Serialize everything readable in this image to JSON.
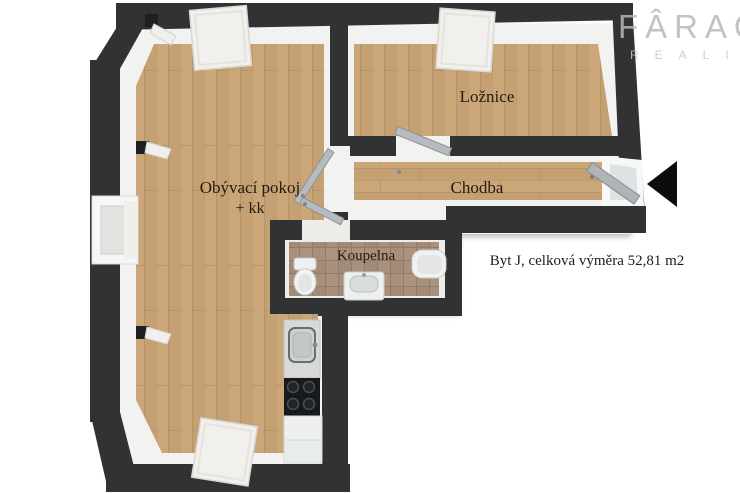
{
  "watermark": {
    "brand": "FÂRAO",
    "subtitle": "REALITY"
  },
  "rooms": {
    "living": {
      "label": "Obývací pokoj",
      "sublabel": "+ kk"
    },
    "bedroom": {
      "label": "Ložnice"
    },
    "hallway": {
      "label": "Chodba"
    },
    "bathroom": {
      "label": "Koupelna"
    }
  },
  "info": {
    "area_label": "Byt J, celková výměra 52,81 m2"
  },
  "colors": {
    "wall": "#303234",
    "inner_face": "#f2f2f0",
    "floor_wood": "#c9a578",
    "floor_tile": "#a8907c",
    "door": "#b5bbbe",
    "entrance_arrow": "#0c0c0c",
    "label_text": "#241b11"
  },
  "fixtures": [
    "skylight-window",
    "side-window",
    "wall-vent",
    "interior-door",
    "entrance-door",
    "kitchen-sink",
    "stove",
    "fridge",
    "toilet",
    "washbasin",
    "bathtub"
  ]
}
